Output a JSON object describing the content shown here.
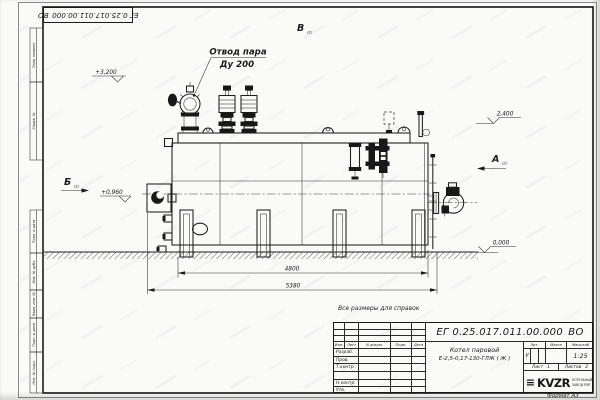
{
  "page": {
    "format_label": "Формат А3",
    "reference_note": "Все размеры для справок",
    "paper_color": "#fafaf7",
    "ink_color": "#1c1c1c"
  },
  "doc": {
    "number": "ЕГ 0.25.017.011.00.000 ВО",
    "product_line1": "Котел паровой",
    "product_line2": "Е-2,5-0,17-130-ГЛЖ ( Ж )"
  },
  "title_block": {
    "columns": {
      "izm": "Изм.",
      "list": "Лист",
      "ndoc": "N докум.",
      "podp": "Подп.",
      "data": "Дата"
    },
    "sign_rows": [
      "Разраб.",
      "Пров.",
      "Т.контр.",
      "Н.контр.",
      "Утв."
    ],
    "lit_label": "Лит.",
    "lit_value": "У",
    "mass_label": "Масса",
    "scale_label": "Масштаб",
    "scale_value": "1:25",
    "sheet_label": "Лист",
    "sheet_value": "1",
    "sheets_label": "Листов",
    "sheets_value": "2",
    "logo_mark": "≡",
    "logo_text": "KVZR",
    "logo_sub1": "КОТЕЛЬНЫЙ",
    "logo_sub2": "ЗАВОД РЭП"
  },
  "margin_boxes": [
    "Перв. примен.",
    "Справ. №",
    "Подп. и дата",
    "Инв. № дубл.",
    "Взам. инв. №",
    "Подп. и дата",
    "Инв. № подл."
  ],
  "annotations": {
    "steam_outlet_line1": "Отвод пара",
    "steam_outlet_line2": "Ду 200",
    "level_top": "+3,200",
    "level_deck": "2,400",
    "level_box": "+0,960",
    "level_ground": "0,000",
    "dim_inner": "4800",
    "dim_overall": "5380",
    "view_a": "А",
    "view_b": "Б",
    "view_v": "В",
    "sheet_ref": "(2)"
  }
}
